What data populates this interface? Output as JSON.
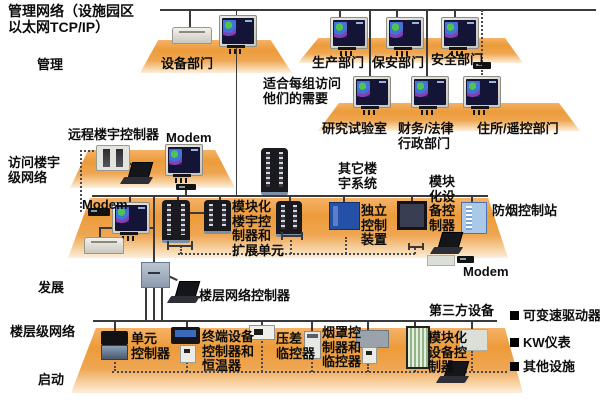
{
  "header": {
    "title": [
      "管理网络（设施园区",
      "以太网TCP/IP）"
    ]
  },
  "stages": {
    "management": "管理",
    "access": [
      "访问楼宇",
      "级网络"
    ],
    "development": "发展",
    "floor_network": "楼层级网络",
    "startup": "启动"
  },
  "top": {
    "equipment_dept": "设备部门",
    "production_dept": "生产部门",
    "security_dept": "保安部门",
    "safety_dept": "安全部门",
    "fit_note": [
      "适合每组访问",
      "他们的需要"
    ],
    "research_lab": "研究试验室",
    "finance_legal": [
      "财务/法律",
      "行政部门"
    ],
    "residence_remote": "住所/遥控部门"
  },
  "mid": {
    "remote_building_controller": "远程楼宇控制器",
    "modem_top": "Modem",
    "modem_left": "Modem",
    "other_building_systems": [
      "其它楼",
      "宇系统"
    ],
    "modular_building_controller": [
      "模块化",
      "楼宇控",
      "制器和",
      "扩展单元"
    ],
    "standalone_control": [
      "独立",
      "控制",
      "装置"
    ],
    "modular_equipment_controller": [
      "模块",
      "化设",
      "备控",
      "制器"
    ],
    "smoke_control_station": "防烟控制站",
    "modem_right": "Modem"
  },
  "dev": {
    "floor_network_controller": "楼层网络控制器"
  },
  "bottom": {
    "third_party": "第三方设备",
    "unit_controller": [
      "单元",
      "控制器"
    ],
    "terminal_controller": [
      "终端设备",
      "控制器和",
      "恒温器"
    ],
    "pressure_monitor": [
      "压差",
      "临控器"
    ],
    "hood_controller": [
      "烟罩控",
      "制器和",
      "临控器"
    ],
    "modular_device_controller": [
      "模块化",
      "设备控",
      "制器"
    ]
  },
  "legend": {
    "items": [
      "可变速驱动器",
      "KW仪表",
      "其他设施"
    ]
  },
  "colors": {
    "platform_orange": "#ec9b3a",
    "line": "#3a3a3a",
    "screen_navy": "#141436",
    "standalone_blue": "#2450a8",
    "smoke_blue": "#aac9e9"
  }
}
